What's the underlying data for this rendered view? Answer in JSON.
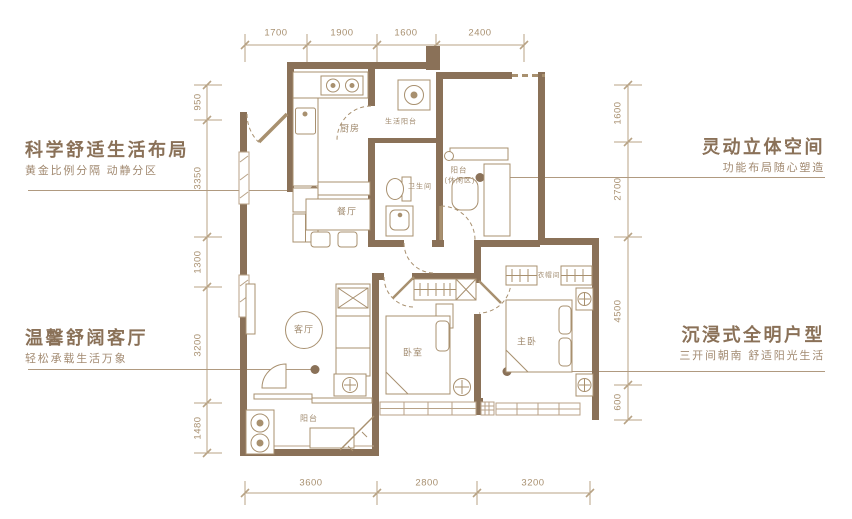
{
  "callouts": {
    "top_left": {
      "title": "科学舒适生活布局",
      "subtitle": "黄金比例分隔 动静分区"
    },
    "bottom_left": {
      "title": "温馨舒阔客厅",
      "subtitle": "轻松承载生活万象"
    },
    "top_right": {
      "title": "灵动立体空间",
      "subtitle": "功能布局随心塑造"
    },
    "bottom_right": {
      "title": "沉浸式全明户型",
      "subtitle": "三开间朝南 舒适阳光生活"
    }
  },
  "dimensions": {
    "top": [
      "1700",
      "1900",
      "1600",
      "2400"
    ],
    "bottom": [
      "3600",
      "2800",
      "3200"
    ],
    "left": [
      "950",
      "3350",
      "1300",
      "3200",
      "1480"
    ],
    "right": [
      "1600",
      "2700",
      "4500",
      "600"
    ]
  },
  "rooms": {
    "kitchen": "厨房",
    "service_balcony": "生活阳台",
    "dining": "餐厅",
    "bathroom": "卫生间",
    "study_line1": "阳台",
    "study_line2": "(休闲区)",
    "living": "客厅",
    "balcony": "阳台",
    "bedroom": "卧室",
    "master": "主卧",
    "cloakroom": "衣帽间"
  },
  "colors": {
    "wall": "#8a7158",
    "line": "#b09a80",
    "furniture": "#a8906f"
  }
}
